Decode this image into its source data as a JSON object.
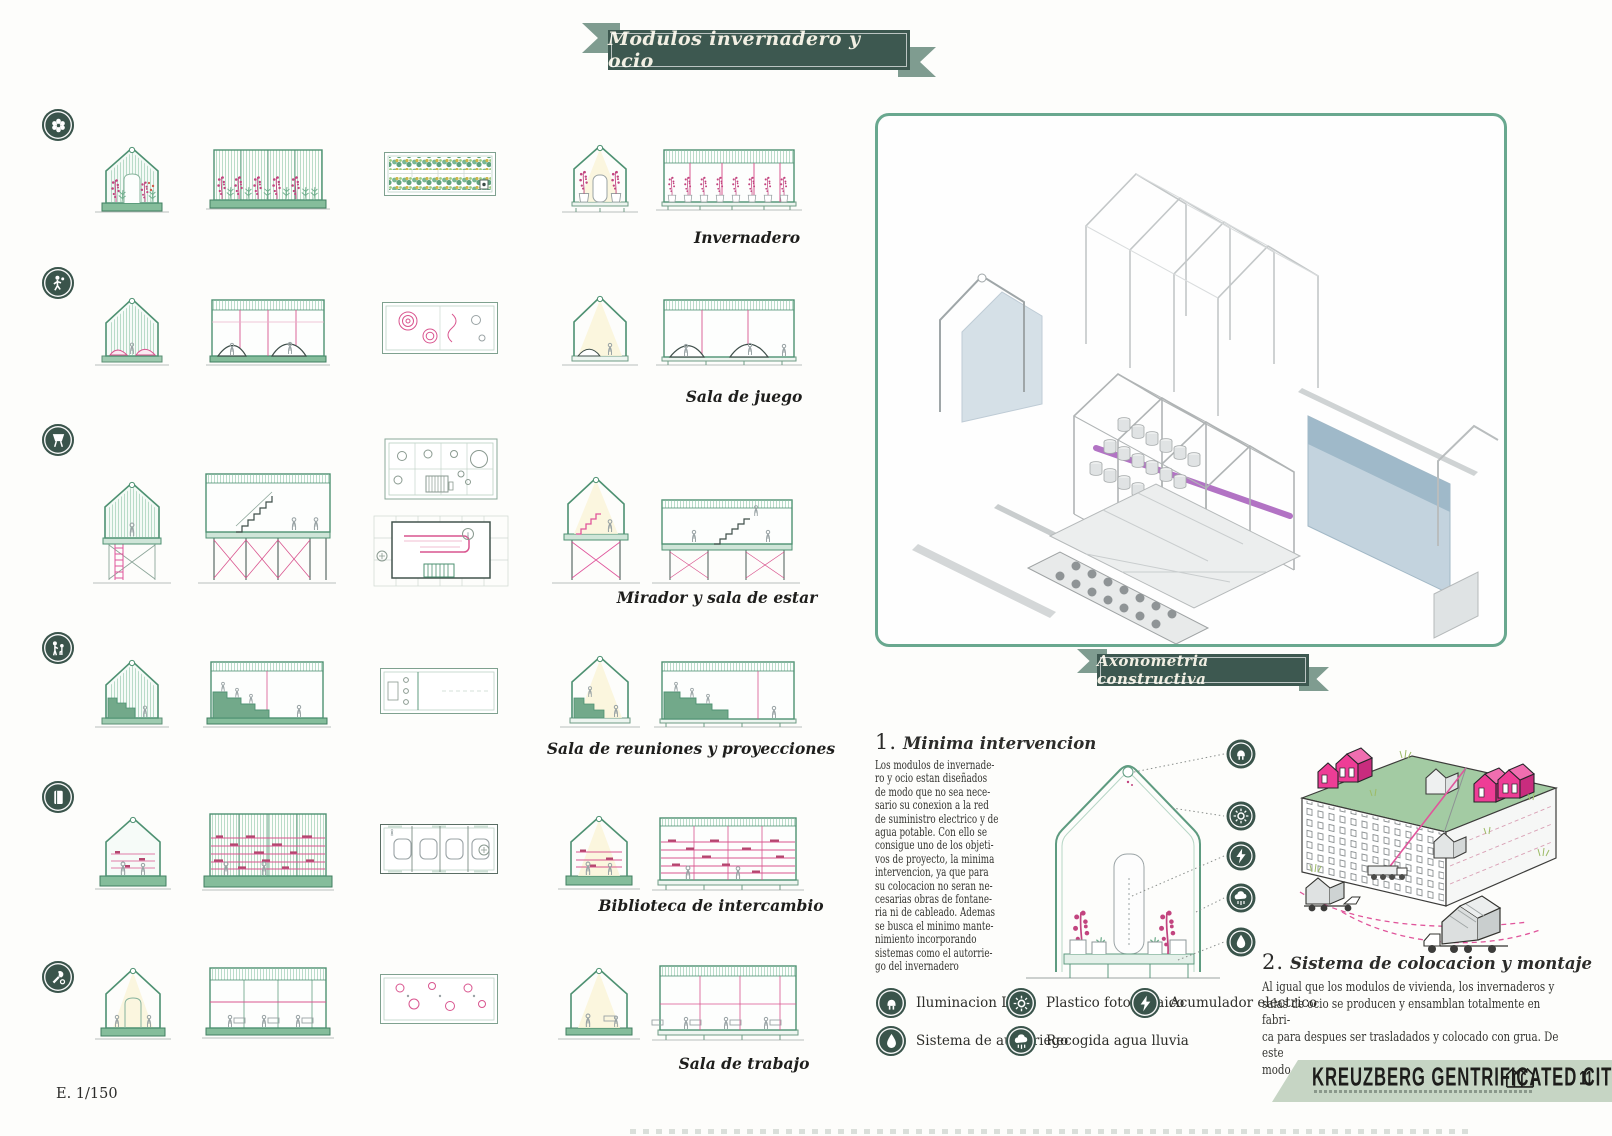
{
  "page": {
    "title": "Modulos invernadero y ocio",
    "axo_title": "Axonometria constructiva",
    "scale_note": "E. 1/150",
    "page_number": "11"
  },
  "modules": [
    {
      "label": "Invernadero",
      "icon": "flower-icon"
    },
    {
      "label": "Sala de juego",
      "icon": "playing-person-icon"
    },
    {
      "label": "Mirador y sala de estar",
      "icon": "lookout-icon"
    },
    {
      "label": "Sala de reuniones y proyecciones",
      "icon": "meeting-people-icon"
    },
    {
      "label": "Biblioteca de intercambio",
      "icon": "book-icon"
    },
    {
      "label": "Sala de trabajo",
      "icon": "tools-icon"
    }
  ],
  "sections": {
    "minima": {
      "number": "1.",
      "title": "Minima intervencion",
      "body": "Los modulos de invernade-\nro y ocio estan diseñados\nde modo que no sea nece-\nsario su conexion a la red\nde suministro electrico y de\nagua potable. Con ello se\nconsigue uno de los objeti-\nvos de proyecto, la minima\nintervencion, ya que para\nsu colocacion no seran ne-\ncesarias obras de fontane-\nria ni de cableado. Ademas\nse busca el minimo mante-\nnimiento incorporando\nsistemas como el autorrie-\ngo del invernadero"
    },
    "montaje": {
      "number": "2.",
      "title": "Sistema de colocacion y montaje",
      "body": "Al igual que los modulos de vivienda, los invernaderos y\nsalas de ocio se producen y ensamblan totalmente en fabri-\nca para despues ser trasladados y colocado con grua. De este\nmodo se consigue abaratar costes y tiempo de ejecucion"
    }
  },
  "legend": [
    {
      "label": "Iluminacion LED",
      "icon": "led-icon"
    },
    {
      "label": "Plastico fotovoltaico",
      "icon": "sun-icon"
    },
    {
      "label": "Acumulador electrico",
      "icon": "lightning-icon"
    },
    {
      "label": "Sistema de autorriego",
      "icon": "water-drop-icon"
    },
    {
      "label": "Recogida agua lluvia",
      "icon": "rain-cloud-icon"
    }
  ],
  "footer": {
    "brand": "KREUZBERG GENTRIFICATED CITY"
  },
  "colors": {
    "banner_green": "#3d5850",
    "drawing_green": "#4e9172",
    "base_green": "#85bd9b",
    "pink": "#d9558f",
    "magenta_house": "#ee3d96",
    "purple_beam": "#b273c4",
    "glass_blue": "#c3d3de",
    "banner_sage": "#c6d5c4"
  }
}
